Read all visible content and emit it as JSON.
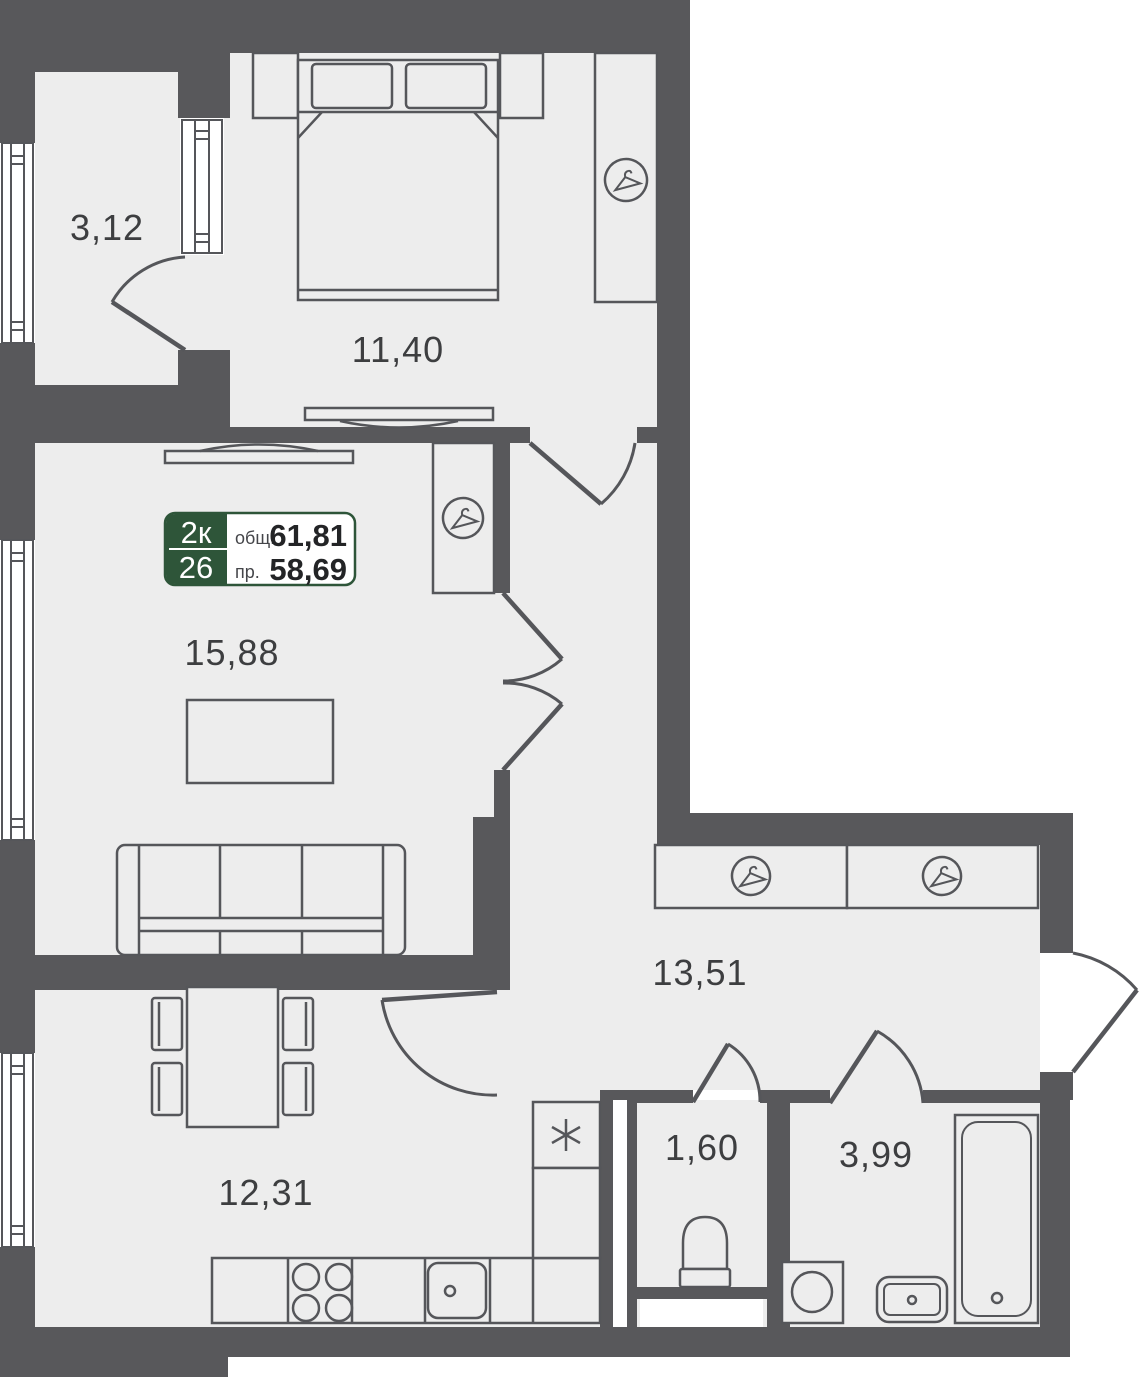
{
  "plan": {
    "title": "apartment-floor-plan",
    "badge": {
      "room_type": "2к",
      "unit_number": "26",
      "total_area_label": "общ.",
      "total_area_value": "61,81",
      "living_area_label": "пр.",
      "living_area_value": "58,69"
    },
    "rooms": [
      {
        "id": "balcony",
        "area": "3,12"
      },
      {
        "id": "bedroom",
        "area": "11,40"
      },
      {
        "id": "living-room",
        "area": "15,88"
      },
      {
        "id": "hallway",
        "area": "13,51"
      },
      {
        "id": "kitchen",
        "area": "12,31"
      },
      {
        "id": "wc",
        "area": "1,60"
      },
      {
        "id": "bathroom",
        "area": "3,99"
      }
    ],
    "colors": {
      "wall": "#58585b",
      "floor": "#ededed",
      "line": "#55565a",
      "accent_green": "#2e5539",
      "label_text": "#3d3e40"
    },
    "icons": [
      "hanger-icon",
      "asterisk-icon"
    ]
  }
}
